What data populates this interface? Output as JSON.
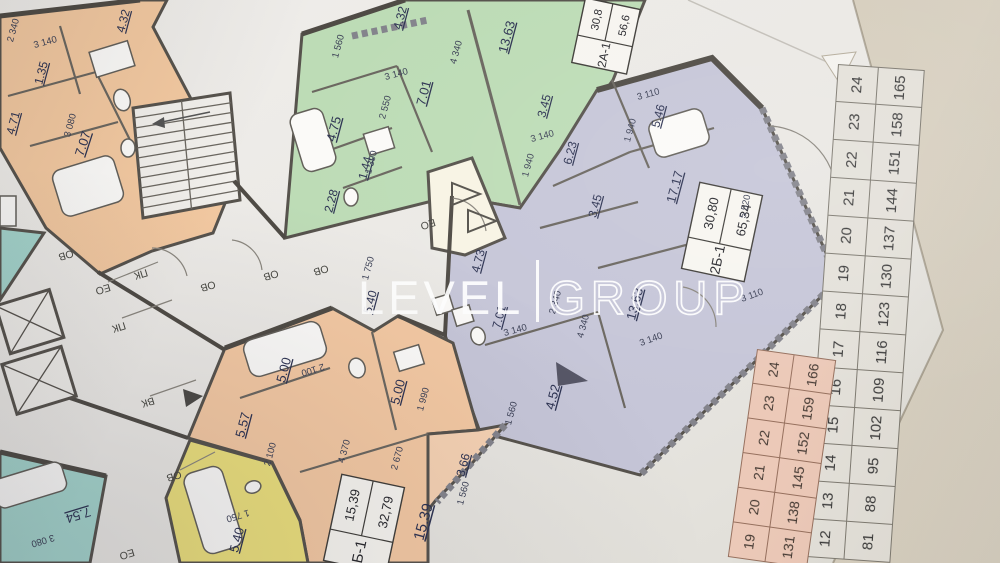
{
  "watermark": {
    "left": "LEVEL",
    "right": "GROUP"
  },
  "plan": {
    "apartment_tags": [
      {
        "id": "2А-1",
        "upper": "30,8",
        "lower": "56,6"
      },
      {
        "id": "2Б-1",
        "upper": "30,80",
        "lower": "65,34"
      },
      {
        "id": "Б-1",
        "upper": "15,39",
        "lower": "32,79"
      }
    ],
    "room_areas": {
      "orange_top": [
        "4.32",
        "1.35",
        "4.71",
        "7.07"
      ],
      "green": [
        "4.32",
        "4.75",
        "1.44",
        "2.28",
        "7.01",
        "13.63",
        "3.45"
      ],
      "purple": [
        "5.46",
        "6.23",
        "17.17",
        "3.45",
        "4.73",
        "13.63",
        "5.40",
        "7.01",
        "4.52"
      ],
      "orange_bottom": [
        "5.00",
        "5.57",
        "5.00",
        "15.39",
        "3.66"
      ],
      "yellow": [
        "5.40"
      ],
      "teal": [
        "7.54"
      ]
    },
    "dimensions": [
      "2 340",
      "3 140",
      "3 080",
      "1 560",
      "3 140",
      "2 550",
      "4 340",
      "1 390",
      "1 940",
      "3 140",
      "3 110",
      "1 940",
      "5 520",
      "3 110",
      "3 140",
      "2 340",
      "4 340",
      "3 140",
      "1 560",
      "1 750",
      "2 100",
      "2 100",
      "1 990",
      "4 370",
      "2 670",
      "1 750",
      "1 560",
      "3 080"
    ],
    "tech_labels": [
      "ОВ",
      "ЕО",
      "ПК",
      "ПК",
      "ВК",
      "ОВ",
      "ЕО",
      "ОВ",
      "ОВ",
      "ОВ",
      "ЕО"
    ]
  },
  "tables": {
    "grey": {
      "floors": [
        24,
        23,
        22,
        21,
        20,
        19,
        18,
        17,
        16,
        15,
        14,
        13,
        12
      ],
      "numbers": [
        165,
        158,
        151,
        144,
        137,
        130,
        123,
        116,
        109,
        102,
        95,
        88,
        81
      ]
    },
    "pink": {
      "floors": [
        24,
        23,
        22,
        21,
        20,
        19
      ],
      "numbers": [
        166,
        159,
        152,
        145,
        138,
        131
      ]
    }
  }
}
